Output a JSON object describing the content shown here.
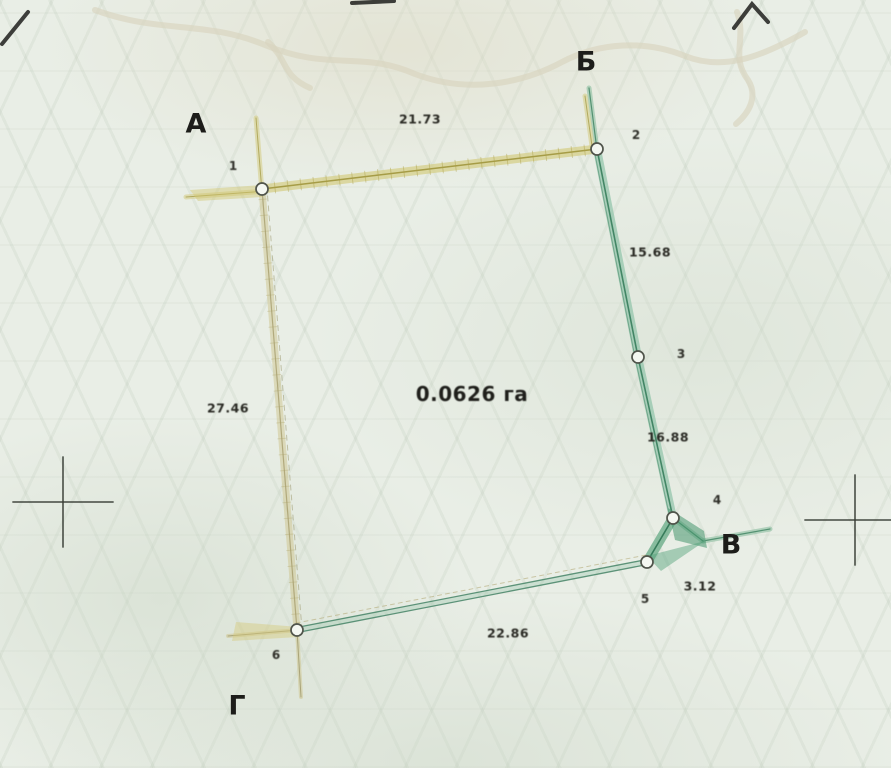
{
  "plan": {
    "area_label": {
      "text": "0.0626 га",
      "x": 472,
      "y": 394
    },
    "corner_letters": [
      {
        "text": "А",
        "x": 196,
        "y": 124
      },
      {
        "text": "Б",
        "x": 586,
        "y": 62
      },
      {
        "text": "В",
        "x": 731,
        "y": 545
      },
      {
        "text": "Г",
        "x": 237,
        "y": 706
      }
    ],
    "point_labels": [
      {
        "text": "1",
        "x": 233,
        "y": 166
      },
      {
        "text": "2",
        "x": 636,
        "y": 135
      },
      {
        "text": "3",
        "x": 681,
        "y": 354
      },
      {
        "text": "4",
        "x": 717,
        "y": 500
      },
      {
        "text": "5",
        "x": 645,
        "y": 599
      },
      {
        "text": "6",
        "x": 276,
        "y": 655
      }
    ],
    "measurements": [
      {
        "text": "21.73",
        "x": 420,
        "y": 119
      },
      {
        "text": "15.68",
        "x": 650,
        "y": 252
      },
      {
        "text": "16.88",
        "x": 668,
        "y": 437
      },
      {
        "text": "27.46",
        "x": 228,
        "y": 408
      },
      {
        "text": "3.12",
        "x": 700,
        "y": 586
      },
      {
        "text": "22.86",
        "x": 508,
        "y": 633
      }
    ],
    "colors": {
      "paper": "#e9eee6",
      "boundary_yellow": "#d6cf8a",
      "boundary_green": "#3f8a66",
      "boundary_tan": "#cdc48c",
      "ink": "#26261f"
    },
    "geometry": {
      "vertices": [
        {
          "x": 262,
          "y": 189
        },
        {
          "x": 597,
          "y": 149
        },
        {
          "x": 638,
          "y": 357
        },
        {
          "x": 673,
          "y": 518
        },
        {
          "x": 647,
          "y": 562
        },
        {
          "x": 297,
          "y": 630
        }
      ],
      "boundary": [
        {
          "from": 0,
          "to": 1,
          "style": "yellow"
        },
        {
          "from": 1,
          "to": 2,
          "style": "green"
        },
        {
          "from": 2,
          "to": 3,
          "style": "green"
        },
        {
          "from": 3,
          "to": 4,
          "style": "greenWedge"
        },
        {
          "from": 4,
          "to": 5,
          "style": "greenThin"
        },
        {
          "from": 5,
          "to": 0,
          "style": "tan"
        }
      ],
      "extensions": [
        {
          "x1": 262,
          "y1": 192,
          "x2": 256,
          "y2": 118,
          "style": "yellowExt"
        },
        {
          "x1": 266,
          "y1": 191,
          "x2": 186,
          "y2": 197,
          "style": "yellowExt"
        },
        {
          "x1": 597,
          "y1": 150,
          "x2": 589,
          "y2": 88,
          "style": "greenExt"
        },
        {
          "x1": 592,
          "y1": 146,
          "x2": 585,
          "y2": 96,
          "style": "yellowExt"
        },
        {
          "x1": 297,
          "y1": 630,
          "x2": 301,
          "y2": 697,
          "style": "tanExt"
        },
        {
          "x1": 299,
          "y1": 630,
          "x2": 228,
          "y2": 636,
          "style": "tanExt"
        },
        {
          "x1": 703,
          "y1": 541,
          "x2": 770,
          "y2": 529,
          "style": "greenExt"
        },
        {
          "x1": 673,
          "y1": 518,
          "x2": 703,
          "y2": 541,
          "style": "greenExt"
        }
      ],
      "wedges": [
        {
          "points": "190,190 262,185 262,197 198,201",
          "fill": "rgba(208,198,110,0.45)"
        },
        {
          "points": "668,508 704,531 707,548 675,540",
          "fill": "rgba(70,150,110,0.55)"
        },
        {
          "points": "647,556 705,541 661,571",
          "fill": "rgba(80,160,120,0.45)"
        },
        {
          "points": "236,622 299,627 299,637 232,641",
          "fill": "rgba(212,202,125,0.45)"
        }
      ],
      "crosshairs": [
        {
          "x": 63,
          "y": 502
        },
        {
          "x": 855,
          "y": 520
        }
      ],
      "contours": [
        "M 95,10 C 160,34 205,20 265,45 C 330,72 360,50 415,74 C 470,95 525,82 562,62 C 600,42 645,40 685,56 C 725,72 765,55 805,32",
        "M 268,42 C 288,60 282,76 310,88",
        "M 737,12 C 747,40 730,56 748,80 C 758,96 750,112 736,124"
      ],
      "scan_marks": [
        "M 2,44 L 28,12",
        "M 352,3 L 394,1",
        "M 734,28 L 752,4 L 768,22"
      ]
    }
  }
}
